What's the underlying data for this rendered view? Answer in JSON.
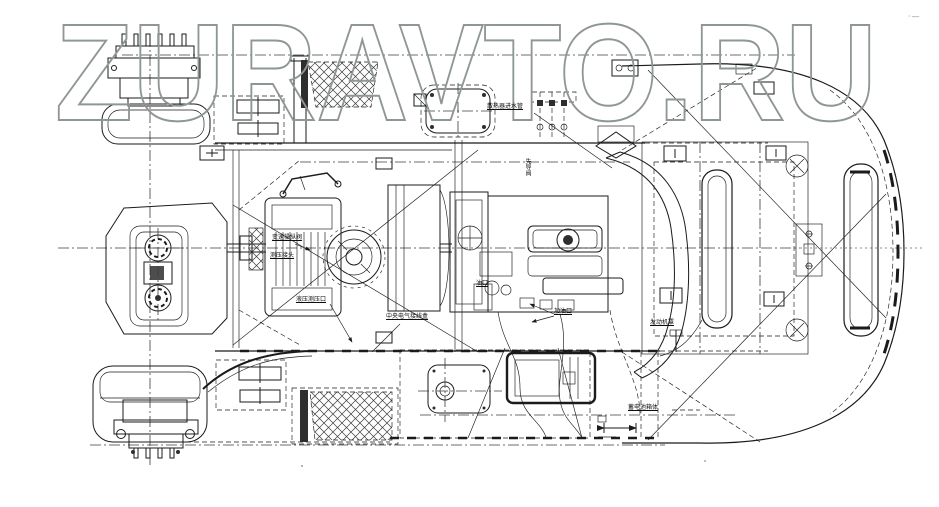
{
  "meta": {
    "description": "Black-and-white CAD assembly drawing, top view of a wheel loader chassis and powertrain with Chinese part callouts",
    "background_color": "#ffffff",
    "line_color": "#1b1b1b"
  },
  "watermark": {
    "text": "ZURAVTO.RU",
    "color": "#8f9696"
  },
  "corner_mark": "·—",
  "drawing": {
    "labels": [
      {
        "id": "radiator-inlet-label",
        "text": "散热器进水管"
      },
      {
        "id": "shift-control-label",
        "text": "变速操纵阀"
      },
      {
        "id": "test-fitting-label",
        "text": "测压接头"
      },
      {
        "id": "hydraulic-port-label",
        "text": "液压测压口"
      },
      {
        "id": "junction-box-label",
        "text": "中央电气接线盒"
      },
      {
        "id": "oil-port-label",
        "text": "油口"
      },
      {
        "id": "pilot-valve-label",
        "text": "先导阀"
      },
      {
        "id": "fill-port-label",
        "text": "加油口"
      },
      {
        "id": "engine-hood-label",
        "text": "发动机罩"
      },
      {
        "id": "battery-box-label",
        "text": "蓄电池箱体"
      }
    ]
  }
}
